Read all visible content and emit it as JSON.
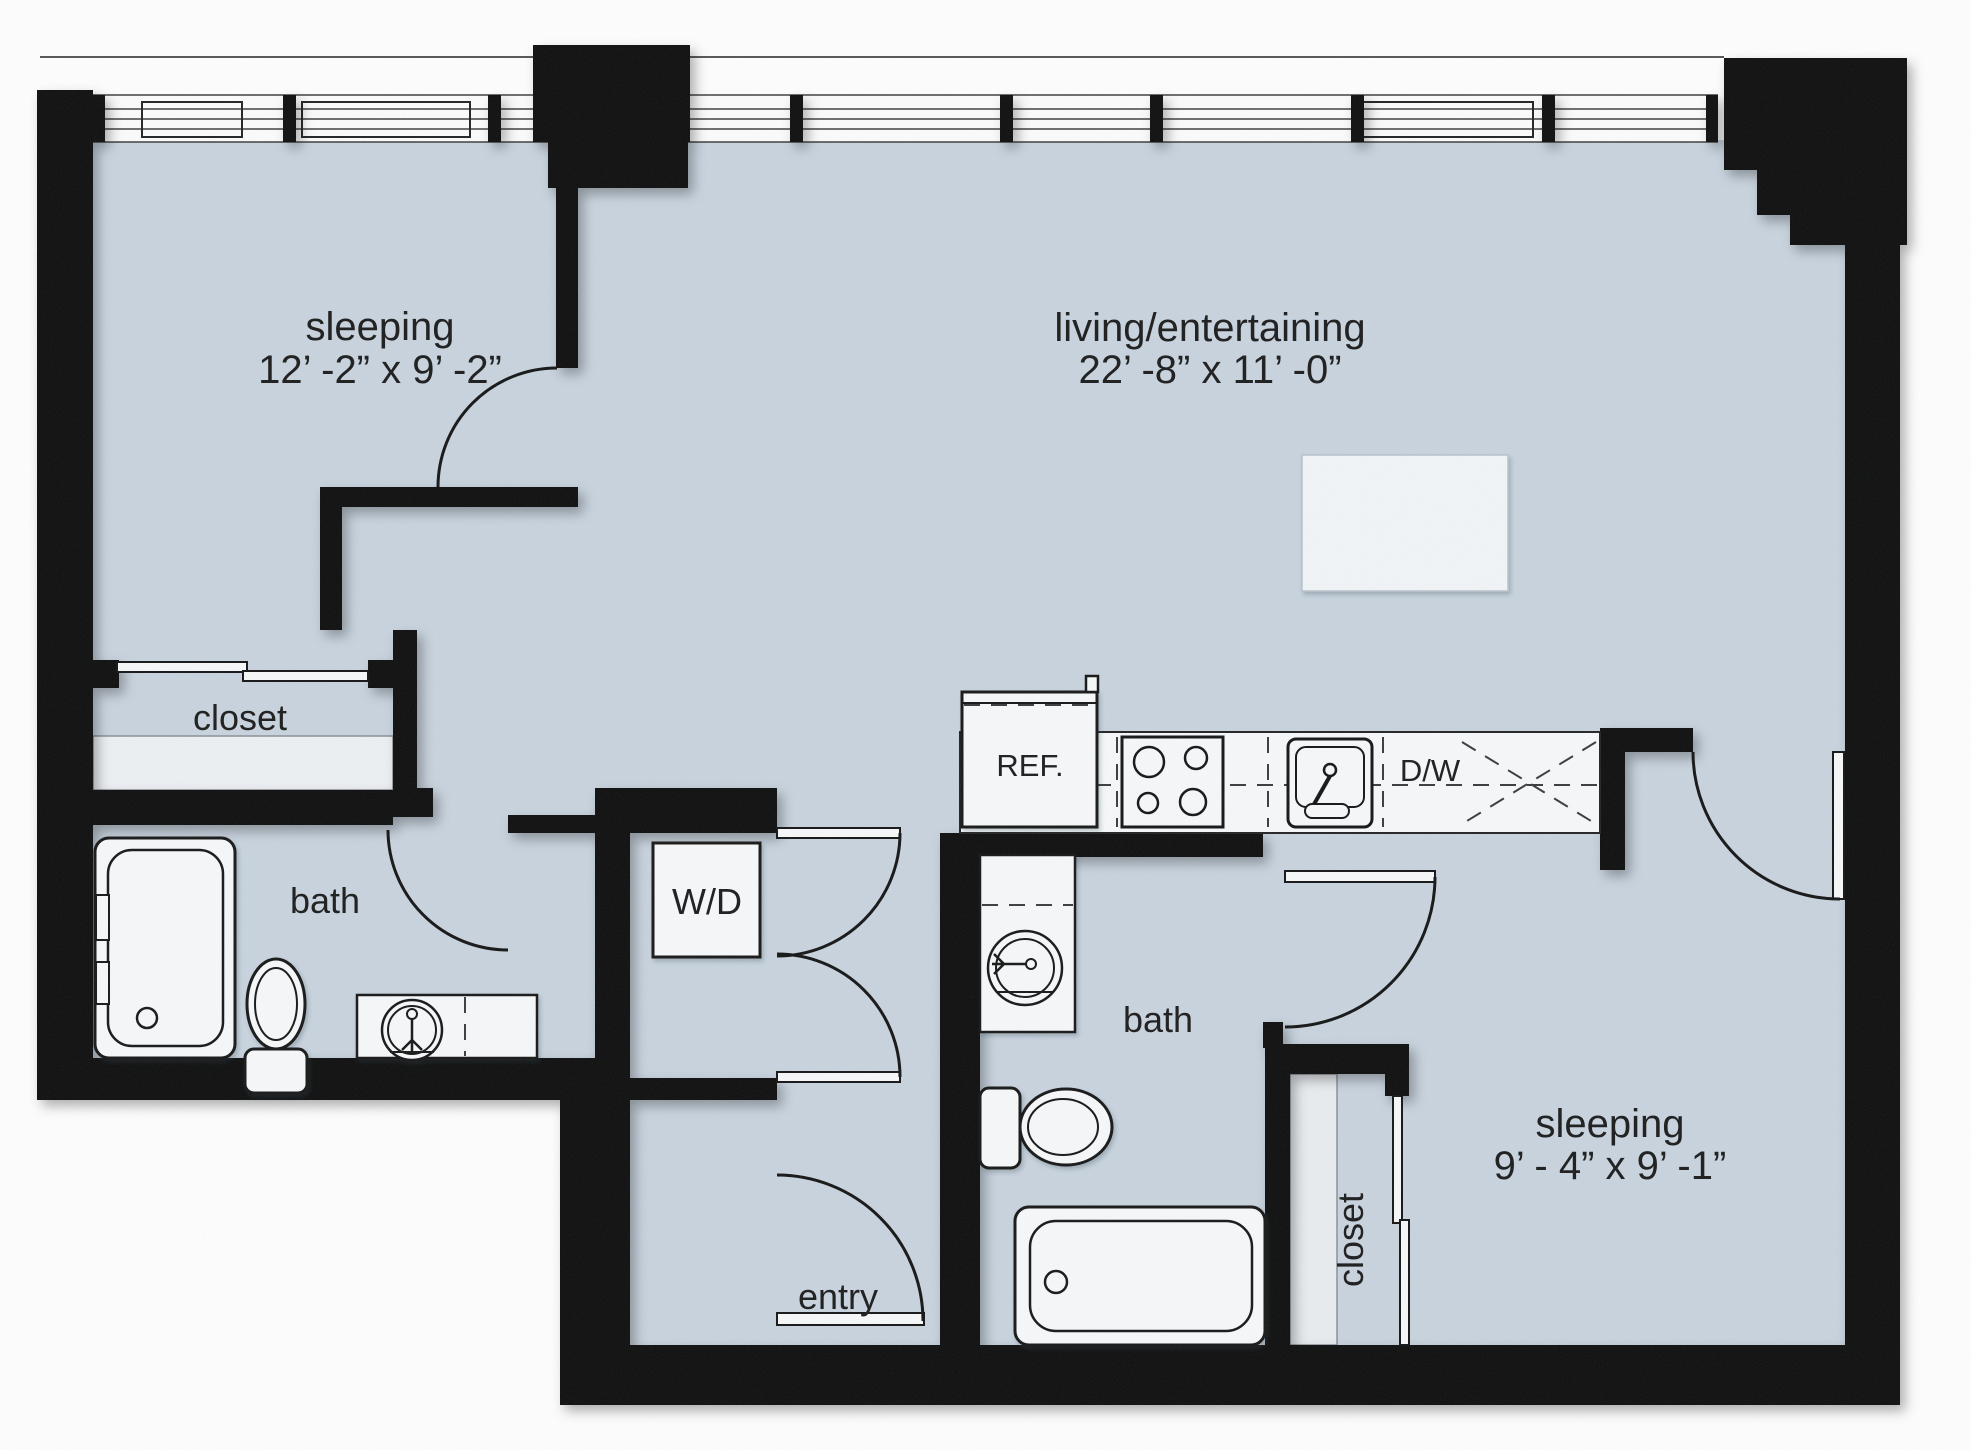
{
  "colors": {
    "floor": "#c9d4df",
    "wall": "#0b0b0b",
    "fixture_fill": "#f7f9fa",
    "label": "#1b1b1b"
  },
  "rooms": {
    "sleeping_left": {
      "name": "sleeping",
      "dims": "12’ -2” x 9’ -2”"
    },
    "living": {
      "name": "living/entertaining",
      "dims": "22’ -8” x 11’ -0”"
    },
    "sleeping_right": {
      "name": "sleeping",
      "dims": "9’ - 4” x 9’ -1”"
    }
  },
  "labels": {
    "closet_left": "closet",
    "bath_left": "bath",
    "washer_dryer": "W/D",
    "refrigerator": "REF.",
    "dishwasher": "D/W",
    "bath_right": "bath",
    "entry": "entry",
    "closet_right": "closet"
  }
}
